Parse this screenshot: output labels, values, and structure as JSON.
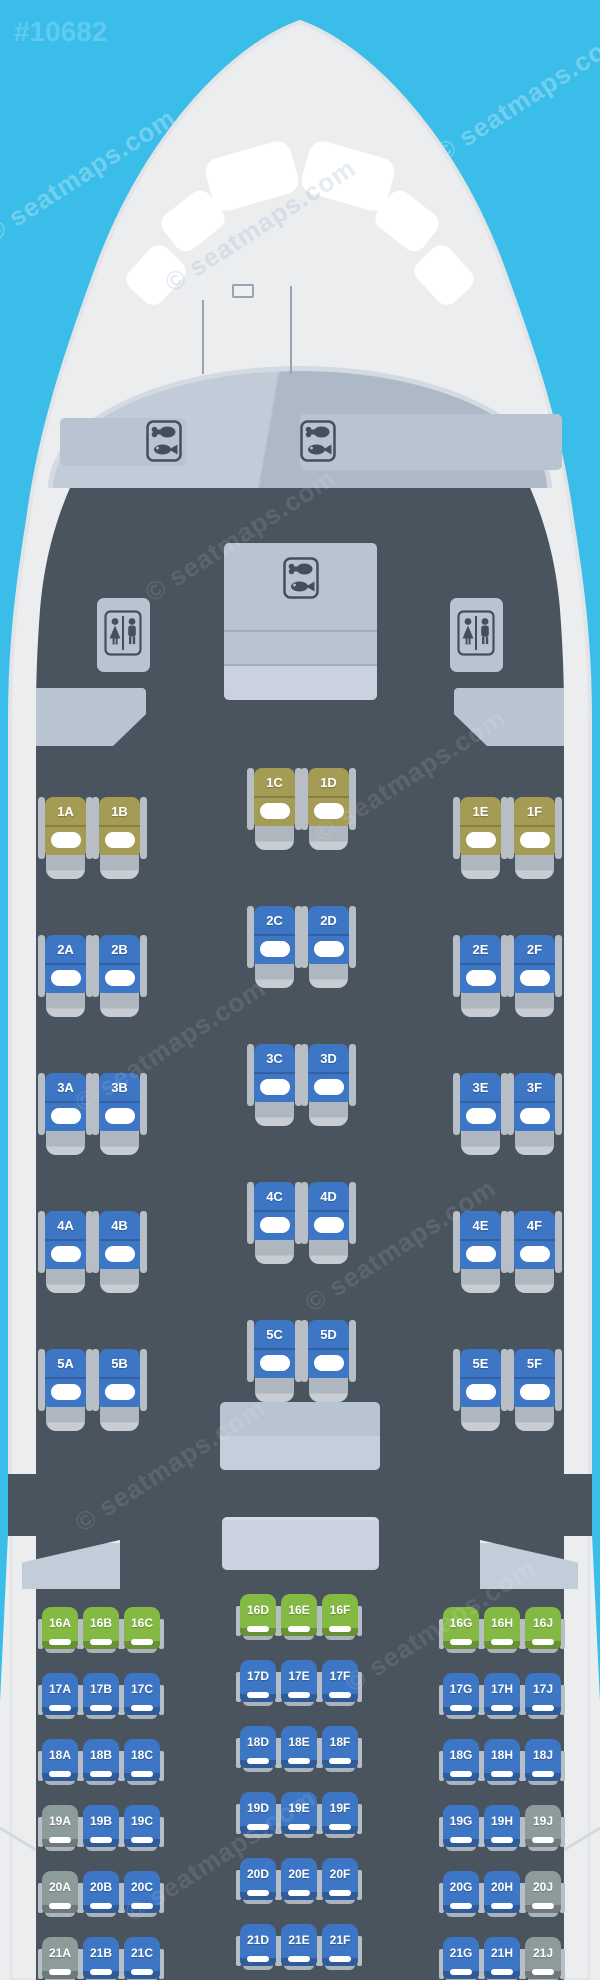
{
  "page_id": "#10682",
  "watermark": "© seatmaps.com",
  "icons": {
    "galley": "drumstick-and-fish-meal-icon",
    "lavatory": "woman-and-man-restroom-icon"
  },
  "colors": {
    "background_cyan": "#3bbde9",
    "fuselage_white": "#ecedef",
    "cabin_dark": "#4a545f",
    "panel_light": "#b9c4d3",
    "seat_blue": "#3d76c4",
    "seat_olive": "#a49b55",
    "seat_green": "#84ba43",
    "seat_gray": "#8e9b9b",
    "armrest_gray": "#b7bec6",
    "cushion_white": "#ffffff"
  },
  "cabin": {
    "business_rows": [
      {
        "row": "1",
        "seats": [
          {
            "id": "1A",
            "col": "A",
            "color": "olive"
          },
          {
            "id": "1B",
            "col": "B",
            "color": "olive"
          },
          {
            "id": "1C",
            "col": "C",
            "color": "olive"
          },
          {
            "id": "1D",
            "col": "D",
            "color": "olive"
          },
          {
            "id": "1E",
            "col": "E",
            "color": "olive"
          },
          {
            "id": "1F",
            "col": "F",
            "color": "olive"
          }
        ]
      },
      {
        "row": "2",
        "seats": [
          {
            "id": "2A",
            "col": "A",
            "color": "blue"
          },
          {
            "id": "2B",
            "col": "B",
            "color": "blue"
          },
          {
            "id": "2C",
            "col": "C",
            "color": "blue"
          },
          {
            "id": "2D",
            "col": "D",
            "color": "blue"
          },
          {
            "id": "2E",
            "col": "E",
            "color": "blue"
          },
          {
            "id": "2F",
            "col": "F",
            "color": "blue"
          }
        ]
      },
      {
        "row": "3",
        "seats": [
          {
            "id": "3A",
            "col": "A",
            "color": "blue"
          },
          {
            "id": "3B",
            "col": "B",
            "color": "blue"
          },
          {
            "id": "3C",
            "col": "C",
            "color": "blue"
          },
          {
            "id": "3D",
            "col": "D",
            "color": "blue"
          },
          {
            "id": "3E",
            "col": "E",
            "color": "blue"
          },
          {
            "id": "3F",
            "col": "F",
            "color": "blue"
          }
        ]
      },
      {
        "row": "4",
        "seats": [
          {
            "id": "4A",
            "col": "A",
            "color": "blue"
          },
          {
            "id": "4B",
            "col": "B",
            "color": "blue"
          },
          {
            "id": "4C",
            "col": "C",
            "color": "blue"
          },
          {
            "id": "4D",
            "col": "D",
            "color": "blue"
          },
          {
            "id": "4E",
            "col": "E",
            "color": "blue"
          },
          {
            "id": "4F",
            "col": "F",
            "color": "blue"
          }
        ]
      },
      {
        "row": "5",
        "seats": [
          {
            "id": "5A",
            "col": "A",
            "color": "blue"
          },
          {
            "id": "5B",
            "col": "B",
            "color": "blue"
          },
          {
            "id": "5C",
            "col": "C",
            "color": "blue"
          },
          {
            "id": "5D",
            "col": "D",
            "color": "blue"
          },
          {
            "id": "5E",
            "col": "E",
            "color": "blue"
          },
          {
            "id": "5F",
            "col": "F",
            "color": "blue"
          }
        ]
      }
    ],
    "economy_rows": [
      {
        "row": "16",
        "seats": [
          {
            "id": "16A",
            "col": "A",
            "color": "green"
          },
          {
            "id": "16B",
            "col": "B",
            "color": "green"
          },
          {
            "id": "16C",
            "col": "C",
            "color": "green"
          },
          {
            "id": "16D",
            "col": "D",
            "color": "green"
          },
          {
            "id": "16E",
            "col": "E",
            "color": "green"
          },
          {
            "id": "16F",
            "col": "F",
            "color": "green"
          },
          {
            "id": "16G",
            "col": "G",
            "color": "green"
          },
          {
            "id": "16H",
            "col": "H",
            "color": "green"
          },
          {
            "id": "16J",
            "col": "J",
            "color": "green"
          }
        ]
      },
      {
        "row": "17",
        "seats": [
          {
            "id": "17A",
            "col": "A",
            "color": "blue"
          },
          {
            "id": "17B",
            "col": "B",
            "color": "blue"
          },
          {
            "id": "17C",
            "col": "C",
            "color": "blue"
          },
          {
            "id": "17D",
            "col": "D",
            "color": "blue"
          },
          {
            "id": "17E",
            "col": "E",
            "color": "blue"
          },
          {
            "id": "17F",
            "col": "F",
            "color": "blue"
          },
          {
            "id": "17G",
            "col": "G",
            "color": "blue"
          },
          {
            "id": "17H",
            "col": "H",
            "color": "blue"
          },
          {
            "id": "17J",
            "col": "J",
            "color": "blue"
          }
        ]
      },
      {
        "row": "18",
        "seats": [
          {
            "id": "18A",
            "col": "A",
            "color": "blue"
          },
          {
            "id": "18B",
            "col": "B",
            "color": "blue"
          },
          {
            "id": "18C",
            "col": "C",
            "color": "blue"
          },
          {
            "id": "18D",
            "col": "D",
            "color": "blue"
          },
          {
            "id": "18E",
            "col": "E",
            "color": "blue"
          },
          {
            "id": "18F",
            "col": "F",
            "color": "blue"
          },
          {
            "id": "18G",
            "col": "G",
            "color": "blue"
          },
          {
            "id": "18H",
            "col": "H",
            "color": "blue"
          },
          {
            "id": "18J",
            "col": "J",
            "color": "blue"
          }
        ]
      },
      {
        "row": "19",
        "seats": [
          {
            "id": "19A",
            "col": "A",
            "color": "gray"
          },
          {
            "id": "19B",
            "col": "B",
            "color": "blue"
          },
          {
            "id": "19C",
            "col": "C",
            "color": "blue"
          },
          {
            "id": "19D",
            "col": "D",
            "color": "blue"
          },
          {
            "id": "19E",
            "col": "E",
            "color": "blue"
          },
          {
            "id": "19F",
            "col": "F",
            "color": "blue"
          },
          {
            "id": "19G",
            "col": "G",
            "color": "blue"
          },
          {
            "id": "19H",
            "col": "H",
            "color": "blue"
          },
          {
            "id": "19J",
            "col": "J",
            "color": "gray"
          }
        ]
      },
      {
        "row": "20",
        "seats": [
          {
            "id": "20A",
            "col": "A",
            "color": "gray"
          },
          {
            "id": "20B",
            "col": "B",
            "color": "blue"
          },
          {
            "id": "20C",
            "col": "C",
            "color": "blue"
          },
          {
            "id": "20D",
            "col": "D",
            "color": "blue"
          },
          {
            "id": "20E",
            "col": "E",
            "color": "blue"
          },
          {
            "id": "20F",
            "col": "F",
            "color": "blue"
          },
          {
            "id": "20G",
            "col": "G",
            "color": "blue"
          },
          {
            "id": "20H",
            "col": "H",
            "color": "blue"
          },
          {
            "id": "20J",
            "col": "J",
            "color": "gray"
          }
        ]
      },
      {
        "row": "21",
        "seats": [
          {
            "id": "21A",
            "col": "A",
            "color": "gray"
          },
          {
            "id": "21B",
            "col": "B",
            "color": "blue"
          },
          {
            "id": "21C",
            "col": "C",
            "color": "blue"
          },
          {
            "id": "21D",
            "col": "D",
            "color": "blue"
          },
          {
            "id": "21E",
            "col": "E",
            "color": "blue"
          },
          {
            "id": "21F",
            "col": "F",
            "color": "blue"
          },
          {
            "id": "21G",
            "col": "G",
            "color": "blue"
          },
          {
            "id": "21H",
            "col": "H",
            "color": "blue"
          },
          {
            "id": "21J",
            "col": "J",
            "color": "gray"
          }
        ]
      }
    ]
  }
}
